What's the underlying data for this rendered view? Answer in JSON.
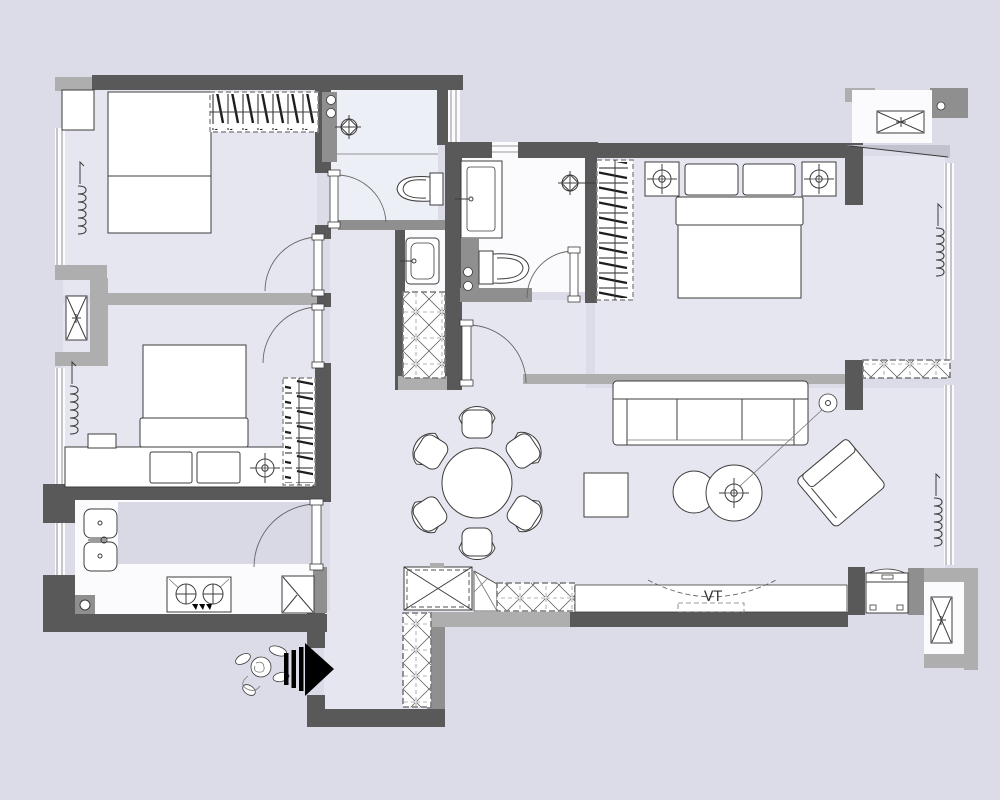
{
  "title": "apartment-floor-plan",
  "labels": {
    "tv_zone": "VT"
  },
  "colors": {
    "bg": "#dcdce8",
    "floor": "#e6e6f0",
    "bath": "#edeff7",
    "white_room": "#fbfbfd",
    "counter": "#d9d9e6",
    "wall_dark": "#595959",
    "wall_mid": "#8f8f8f",
    "wall_light": "#aeaeae",
    "line": "#3c3c3c",
    "arrow": "#000000",
    "text": "#333333"
  },
  "icons": {
    "ceiling-light-icon": "crosshair-circle",
    "shower-head-icon": "diamond-crosshair-circle",
    "curtain-coil-icon": "spring-coil",
    "entry-arrow-icon": "black-triangle-bars",
    "person-sketch-icon": "hand-drawn-figure",
    "ac-unit-icon": "crossed-box",
    "wardrobe-icon": "hanger-hatch",
    "cabinet-icon": "x-hatch"
  }
}
